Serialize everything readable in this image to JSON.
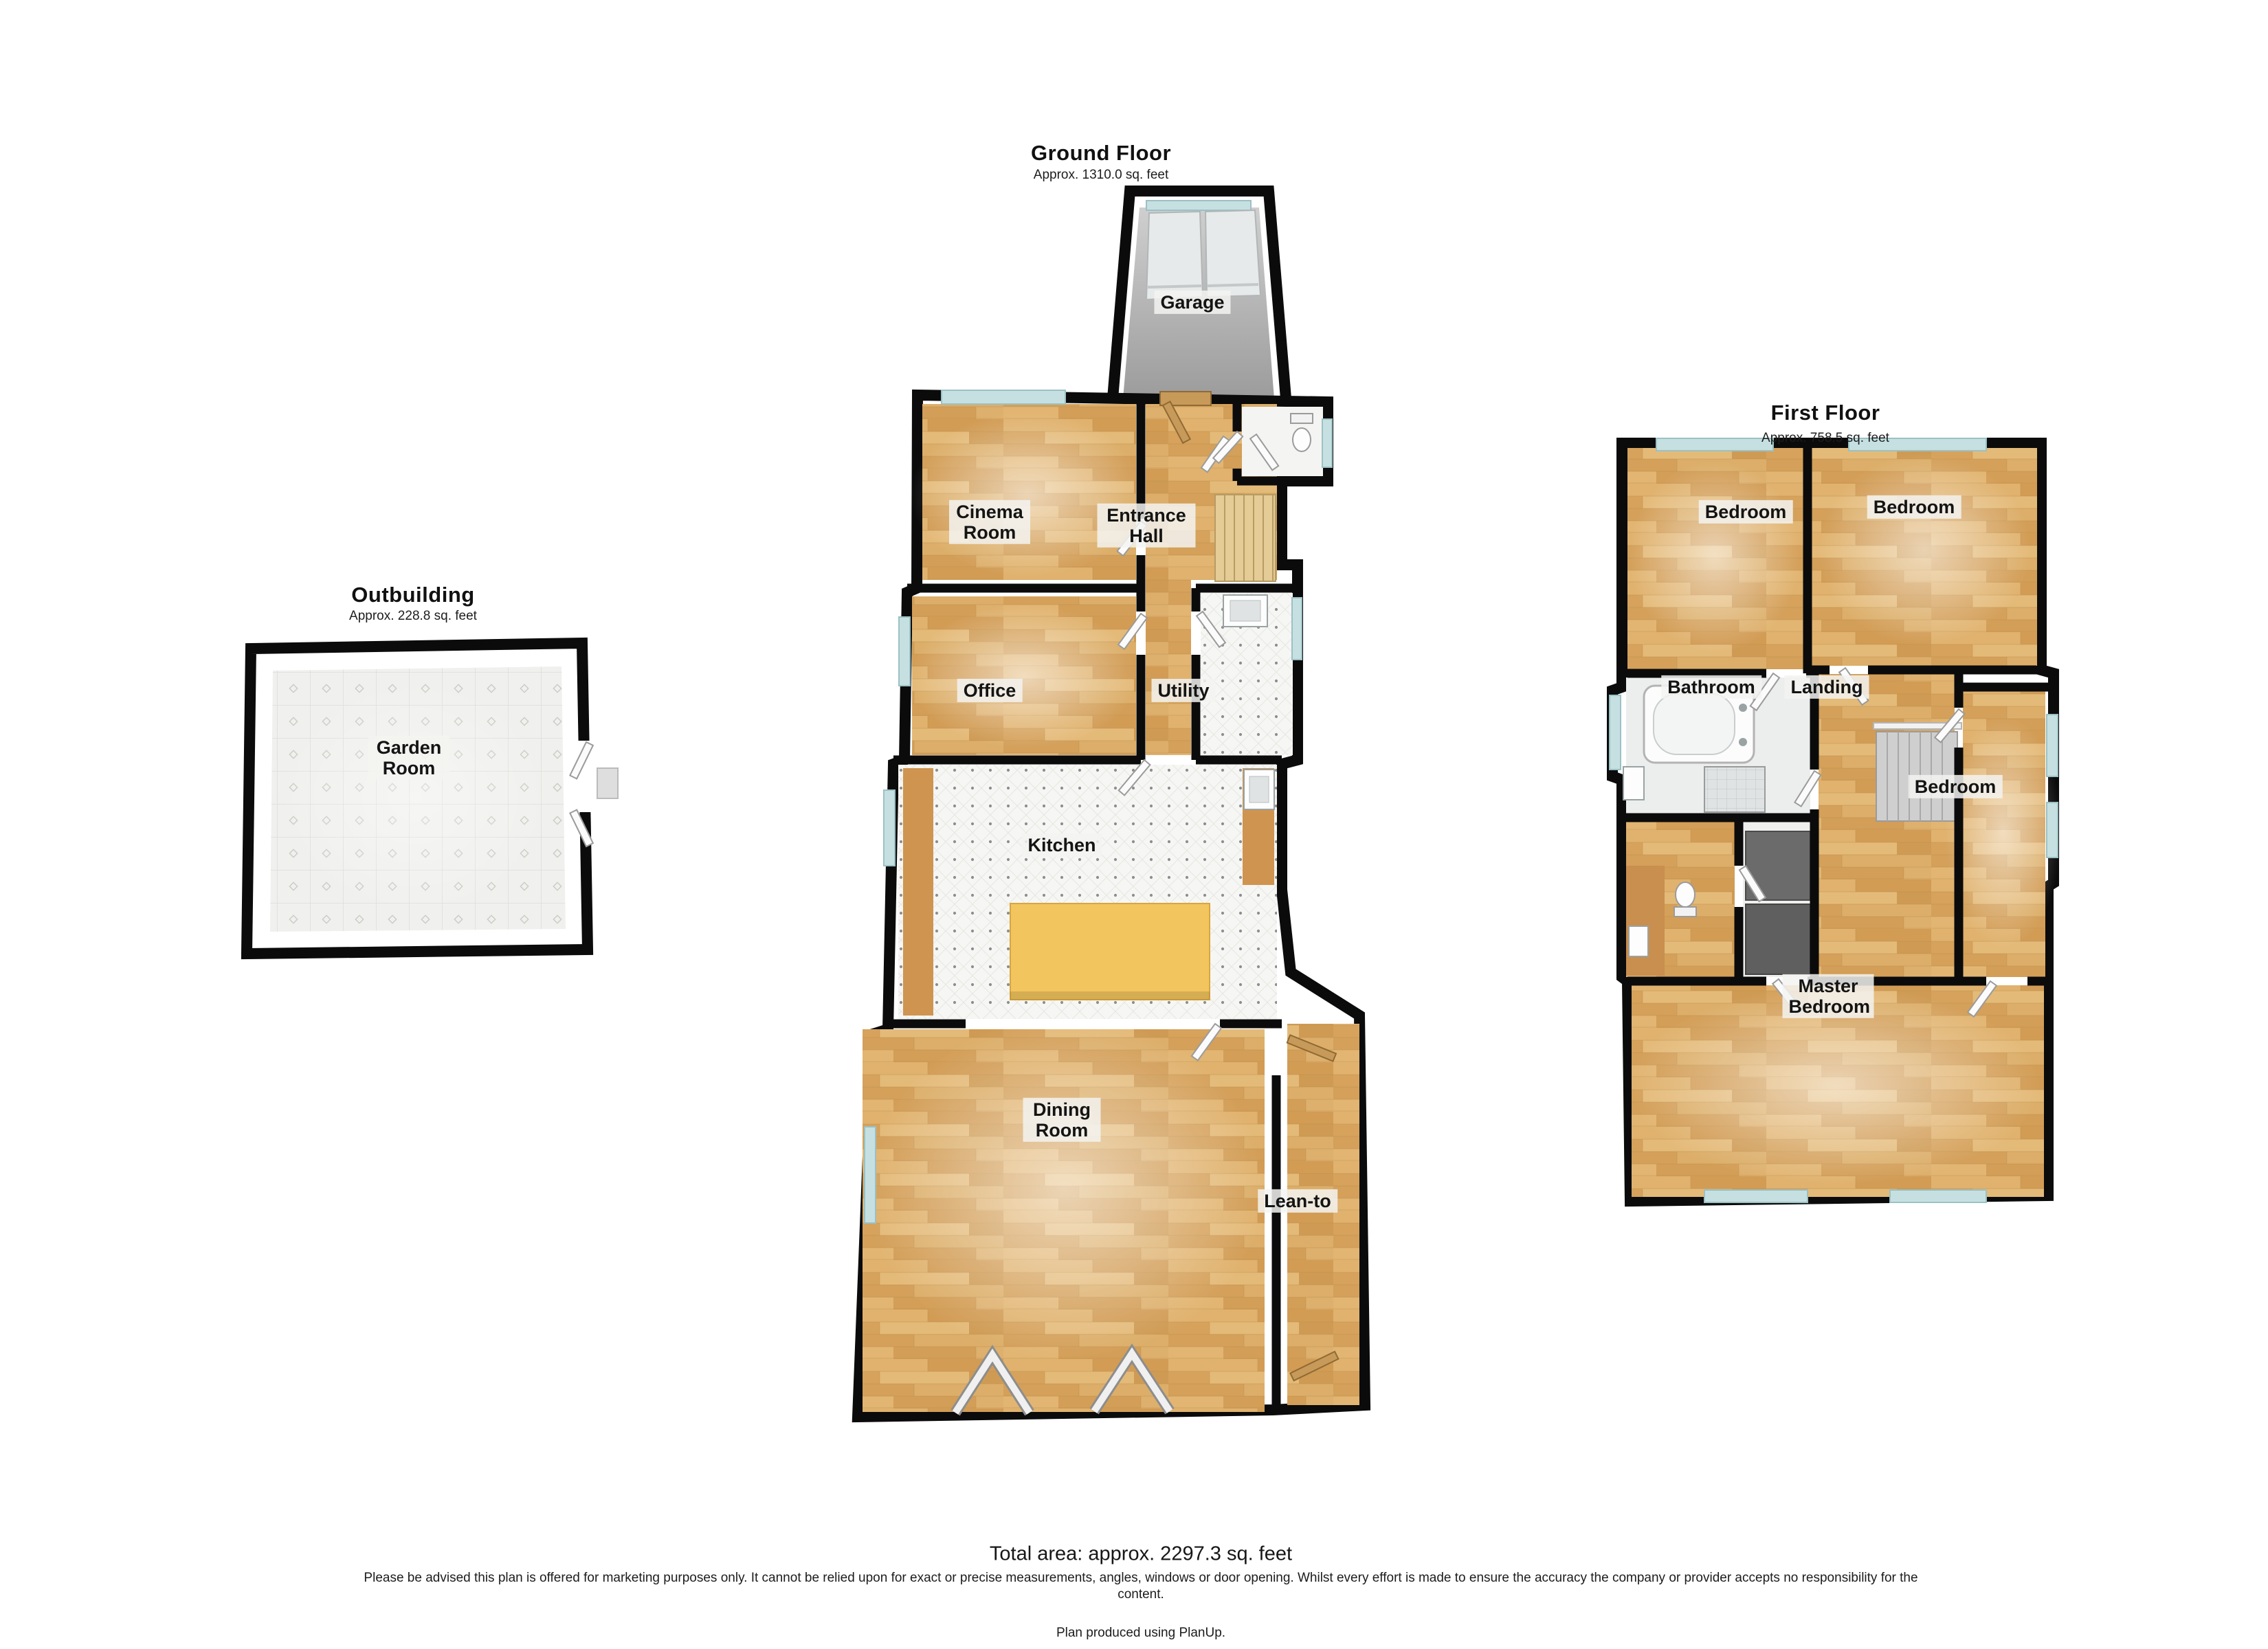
{
  "plans": {
    "ground_floor": {
      "title": "Ground Floor",
      "subtitle": "Approx. 1310.0 sq. feet",
      "rooms": [
        "Garage",
        "Cinema Room",
        "Entrance Hall",
        "Office",
        "Utility",
        "Kitchen",
        "Dining Room",
        "Lean-to"
      ]
    },
    "outbuilding": {
      "title": "Outbuilding",
      "subtitle": "Approx. 228.8 sq. feet",
      "rooms": [
        "Garden Room"
      ]
    },
    "first_floor": {
      "title": "First Floor",
      "subtitle": "Approx. 758.5 sq. feet",
      "rooms": [
        "Bedroom",
        "Bedroom",
        "Bathroom",
        "Landing",
        "Bedroom",
        "Master Bedroom"
      ]
    }
  },
  "footer": {
    "total_area": "Total area: approx. 2297.3 sq. feet",
    "disclaimer_line1": "Please be advised this plan is offered for marketing purposes only. It cannot be relied upon for exact or precise measurements, angles, windows or door opening. Whilst every effort is made to ensure the accuracy the company or provider accepts no responsibility for the",
    "disclaimer_line2": "content.",
    "credit": "Plan produced using PlanUp."
  },
  "colors": {
    "wall": "#0b0b0b",
    "wood_floor": "#d9a65f",
    "tile_floor": "#f6f6f4",
    "garage_floor": "#b5b5b5",
    "window": "#c6e0e2",
    "kitchen_island": "#f3c55e",
    "stairs": "#e5cc96",
    "counter": "#cf9450",
    "external_door": "#c79a5a"
  }
}
